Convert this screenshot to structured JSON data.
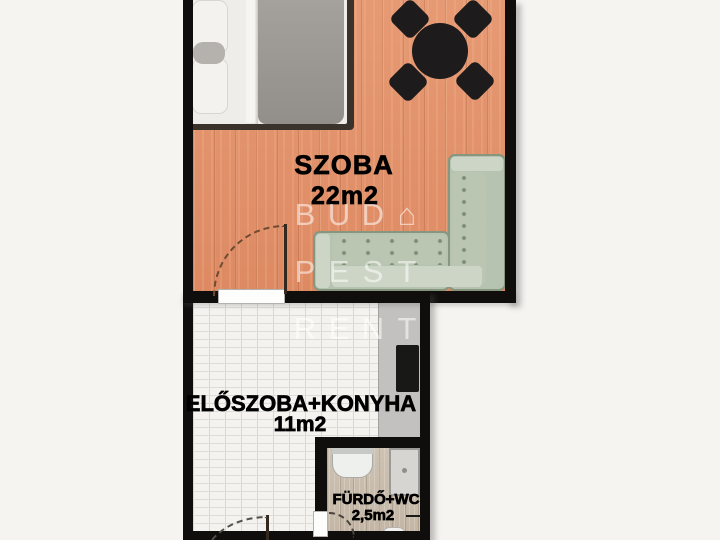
{
  "rooms": {
    "szoba": {
      "name": "SZOBA",
      "area": "22m2"
    },
    "eloszoba": {
      "name": "ELŐSZOBA+KONYHA",
      "area": "11m2"
    },
    "furdo": {
      "name": "FÜRDŐ+WC",
      "area": "2,5m2"
    }
  },
  "watermark": {
    "rows": [
      [
        "B",
        "U",
        "D",
        "⌂"
      ],
      [
        "P",
        "E",
        "S",
        "T"
      ],
      [
        "R",
        "E",
        "N",
        "T"
      ]
    ]
  },
  "colors": {
    "wood_floor": "#e2926c",
    "tile_floor": "#f4f3f0",
    "bath_floor": "#c9bdae",
    "wall": "#0f0e0d",
    "sofa": "#b7c3b1",
    "counter": "#c2c1bf",
    "background": "#f5f4f1"
  }
}
